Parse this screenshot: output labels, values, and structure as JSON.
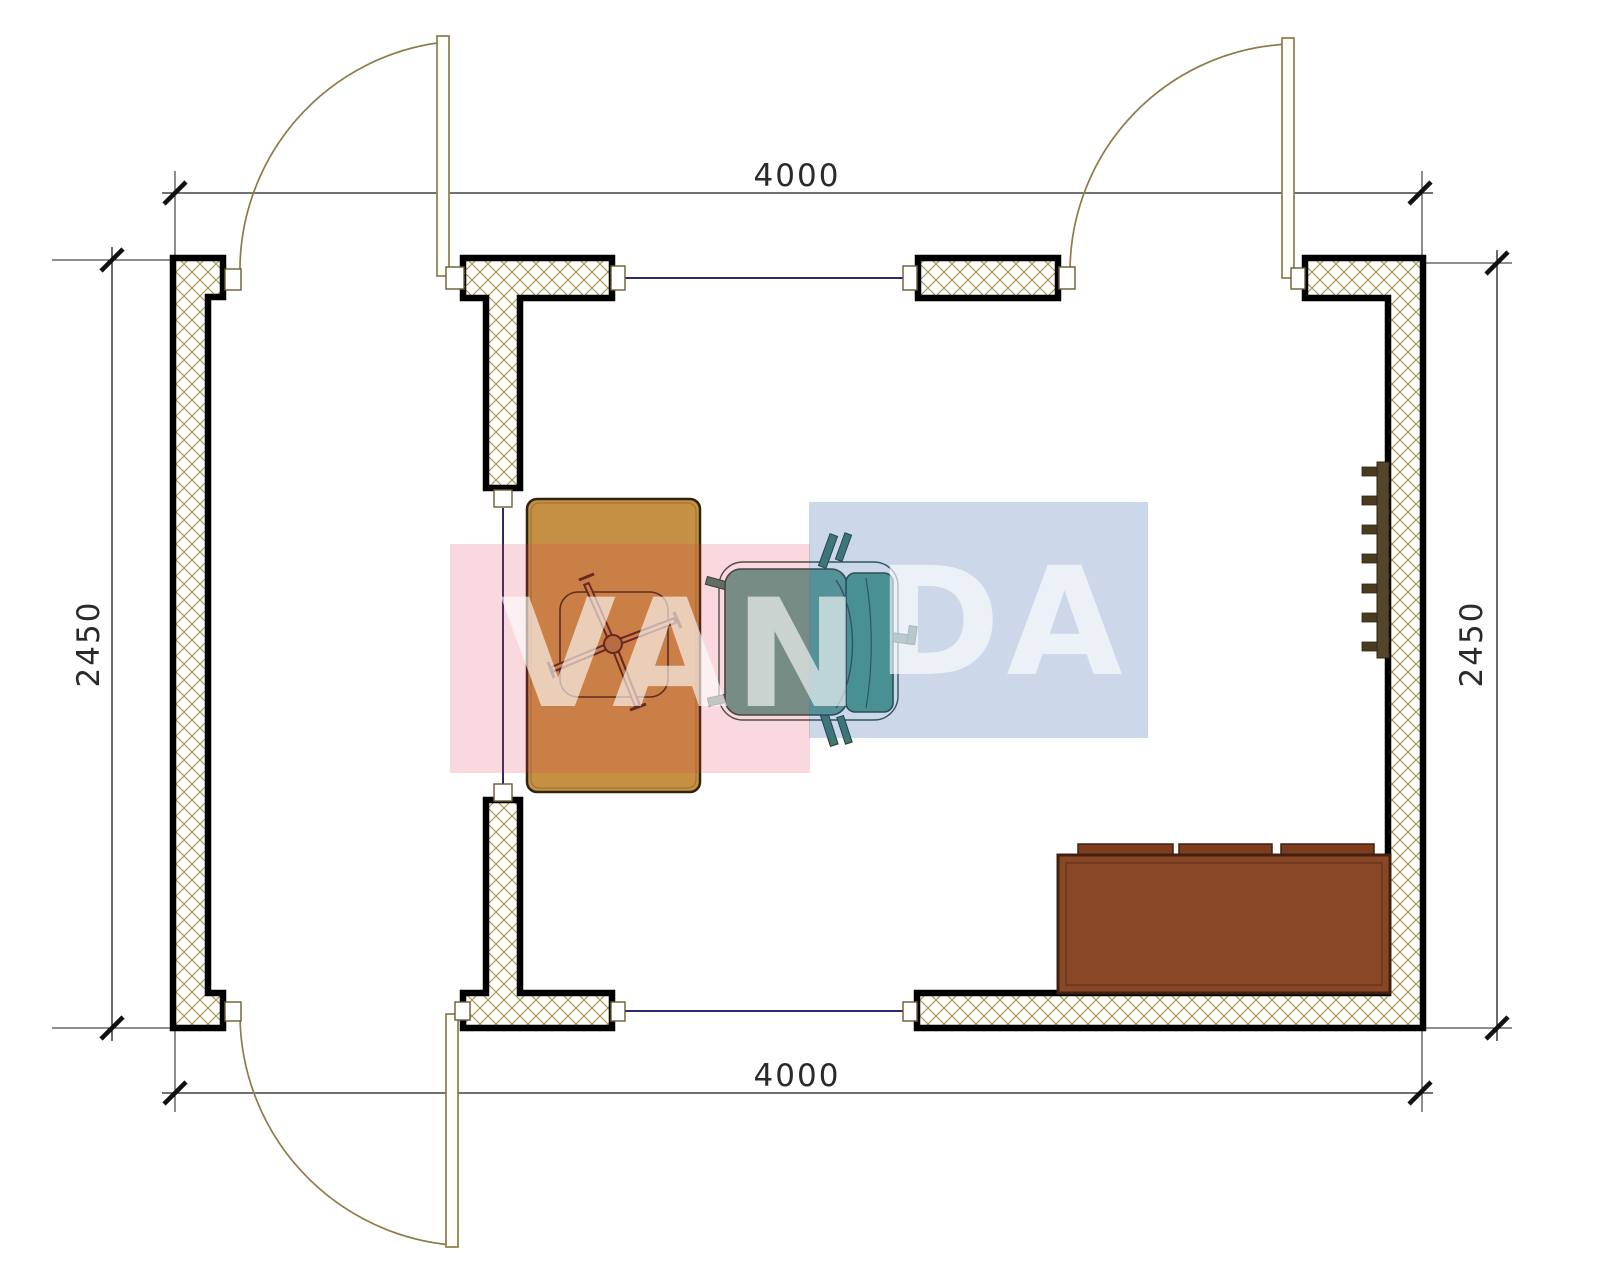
{
  "drawing": {
    "type": "architectural floor plan, top view, single room 4000 x 2450 mm",
    "dimensions": {
      "top": "4000",
      "bottom": "4000",
      "left": "2450",
      "right": "2450"
    },
    "watermark": {
      "text": "VANDA",
      "part_left": "VAN",
      "part_right": "DA",
      "pink_color": "#e03e58",
      "blue_color": "#3e64ac",
      "letter_color": "#ffffff"
    },
    "colors": {
      "wall_outline": "#000000",
      "wall_hatch_line": "#a39258",
      "wall_hatch_bg": "#fcfbf6",
      "door_line": "#8d7b4a",
      "window_line": "#2b2b6b",
      "dimension_line": "#1c1c1c",
      "desk": "#c59042",
      "desk_chair_lines": "#4a2318",
      "office_chair_seat": "#5ea192",
      "office_chair_back": "#4da08c",
      "sofa": "#8a4728",
      "sofa_cushion": "#7d3c20",
      "radiator": "#55452a"
    },
    "furniture": [
      "desk",
      "desk-chair",
      "office-chair",
      "sofa",
      "radiator"
    ],
    "openings": {
      "doors": 3,
      "windows": 2,
      "interior-opening": 1
    }
  }
}
